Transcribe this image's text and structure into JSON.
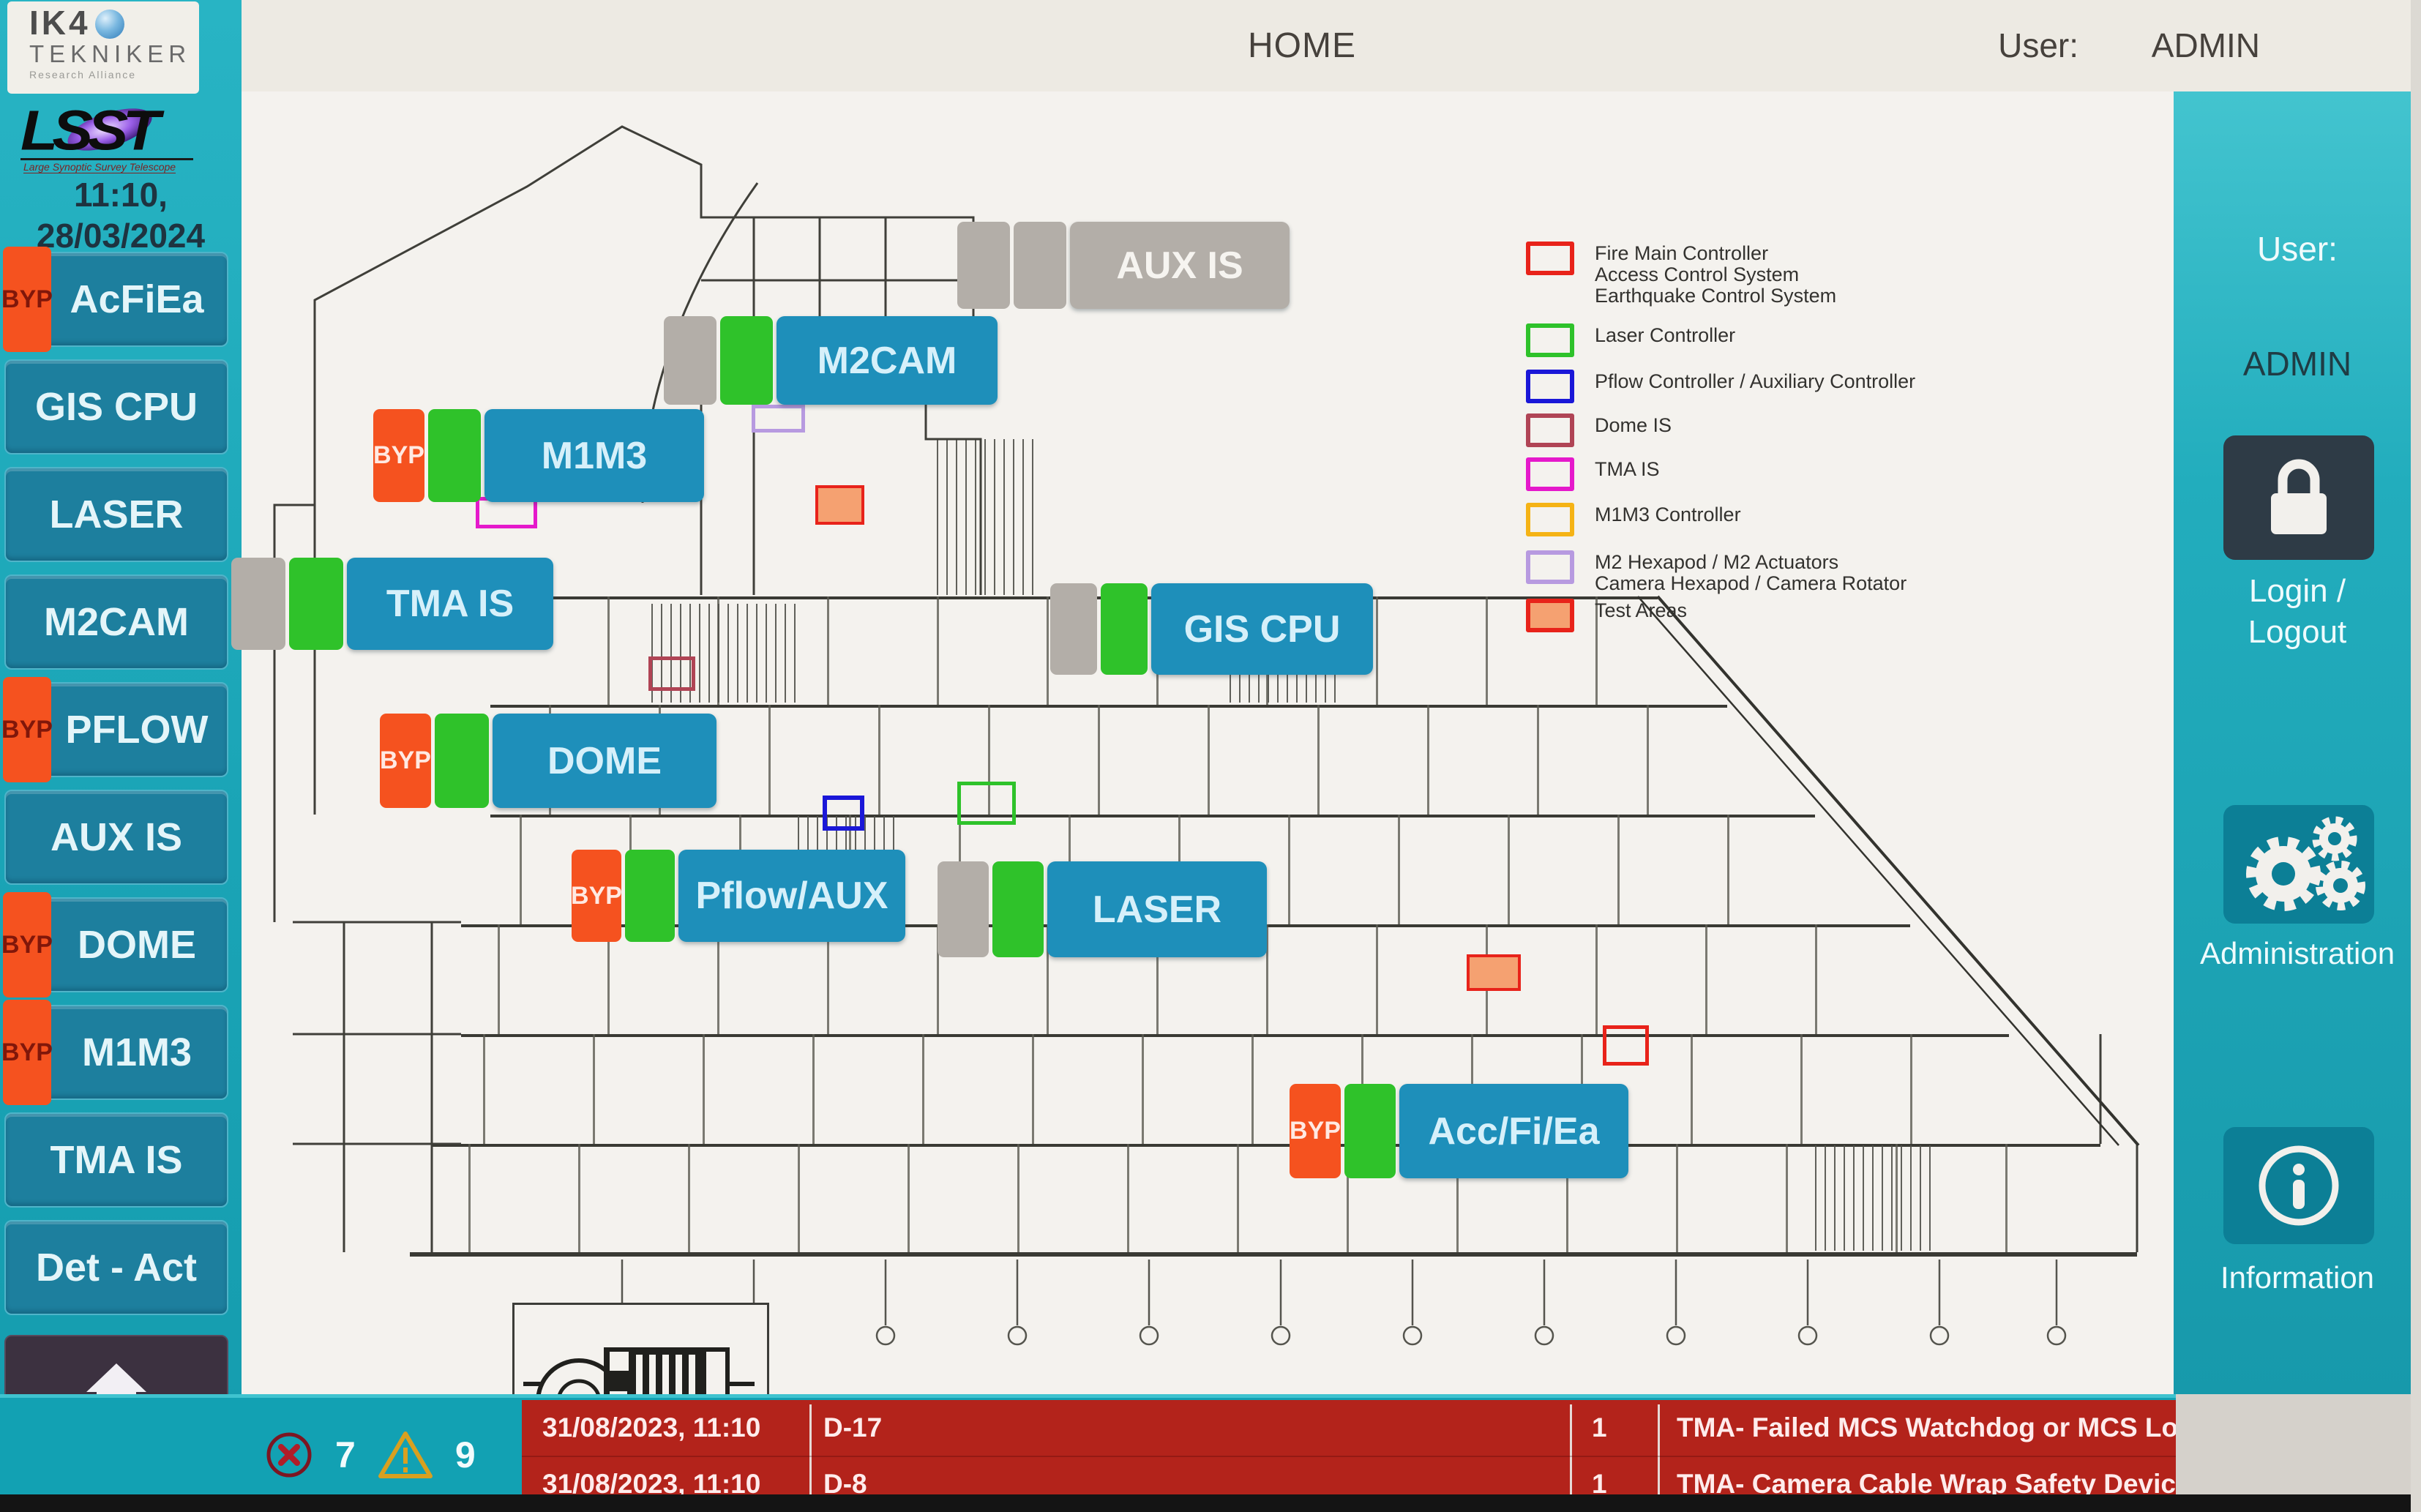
{
  "header": {
    "title": "HOME",
    "user_label": "User:",
    "user_value": "ADMIN"
  },
  "branding": {
    "ik4_name": "IK4",
    "ik4_sub": "TEKNIKER",
    "ik4_tagline": "Research Alliance",
    "lsst_name": "LSST",
    "lsst_tagline": "Large Synoptic Survey Telescope"
  },
  "clock": {
    "time": "11:10,",
    "date": "28/03/2024"
  },
  "left_sidebar": {
    "byp_label": "BYP",
    "items": [
      {
        "label": "AcFiEa",
        "byp": true
      },
      {
        "label": "GIS CPU",
        "byp": false
      },
      {
        "label": "LASER",
        "byp": false
      },
      {
        "label": "M2CAM",
        "byp": false
      },
      {
        "label": "PFLOW",
        "byp": true
      },
      {
        "label": "AUX IS",
        "byp": false
      },
      {
        "label": "DOME",
        "byp": true
      },
      {
        "label": "M1M3",
        "byp": true
      },
      {
        "label": "TMA IS",
        "byp": false
      },
      {
        "label": "Det - Act",
        "byp": false
      }
    ]
  },
  "map": {
    "byp_label": "BYP",
    "overlays": [
      {
        "label": "AUX IS",
        "state": "offline"
      },
      {
        "label": "M2CAM",
        "state": "online"
      },
      {
        "label": "M1M3",
        "state": "online",
        "byp": true
      },
      {
        "label": "TMA IS",
        "state": "online"
      },
      {
        "label": "GIS CPU",
        "state": "online"
      },
      {
        "label": "DOME",
        "state": "online",
        "byp": true
      },
      {
        "label": "Pflow/AUX",
        "state": "online",
        "byp": true
      },
      {
        "label": "LASER",
        "state": "online"
      },
      {
        "label": "Acc/Fi/Ea",
        "state": "online",
        "byp": true
      }
    ]
  },
  "legend": {
    "items": [
      {
        "label": "Fire Main Controller\nAccess Control System\nEarthquake Control System",
        "color": "#e8231a",
        "fill": "transparent"
      },
      {
        "label": "Laser Controller",
        "color": "#2ec22a",
        "fill": "transparent"
      },
      {
        "label": "Pflow Controller / Auxiliary Controller",
        "color": "#1a17d8",
        "fill": "transparent"
      },
      {
        "label": "Dome IS",
        "color": "#b04455",
        "fill": "transparent"
      },
      {
        "label": "TMA IS",
        "color": "#e519cb",
        "fill": "transparent"
      },
      {
        "label": "M1M3 Controller",
        "color": "#f5b315",
        "fill": "transparent"
      },
      {
        "label": "M2 Hexapod / M2 Actuators\nCamera Hexapod / Camera Rotator",
        "color": "#b79ae0",
        "fill": "transparent"
      },
      {
        "label": "Test Areas",
        "color": "#e8231a",
        "fill": "#f5a171"
      }
    ]
  },
  "right_sidebar": {
    "user_label": "User:",
    "user_value": "ADMIN",
    "login_line1": "Login /",
    "login_line2": "Logout",
    "admin_label": "Administration",
    "info_label": "Information"
  },
  "alarm_bar": {
    "error_count": "7",
    "warning_count": "9",
    "rows": [
      {
        "time": "31/08/2023, 11:10",
        "code": "D-17",
        "count": "1",
        "message": "TMA- Failed MCS Watchdog or MCS Loss communication"
      },
      {
        "time": "31/08/2023, 11:10",
        "code": "D-8",
        "count": "1",
        "message": "TMA- Camera Cable Wrap Safety Device Actuated"
      }
    ]
  },
  "icons": {
    "home": "house-shape",
    "error": "circle-x",
    "warning": "triangle-exclamation",
    "lock": "padlock",
    "administration": "gears",
    "information": "circle-i"
  },
  "colors": {
    "accent_teal": "#1aa4b6",
    "panel_teal": "#1d7f9e",
    "overlay_blue": "#1e8fba",
    "status_green": "#2fc22a",
    "status_grey": "#b3aea8",
    "byp_orange": "#f5521f",
    "alarm_red": "#b3231b",
    "test_area_fill": "#f5a171"
  }
}
